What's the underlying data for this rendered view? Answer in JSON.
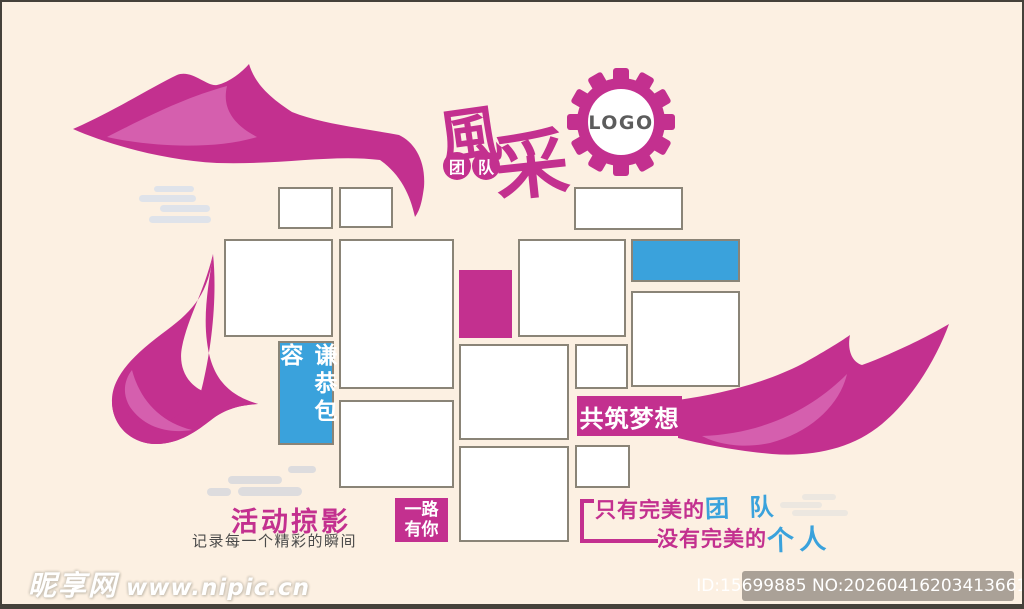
{
  "colors": {
    "background": "#fcf0e2",
    "magenta": "#c3308f",
    "magenta_light": "#d55fae",
    "blue": "#3aa2dc",
    "frame_border": "#8a8477",
    "subtitle_gray": "#4b4b4b",
    "logo_gray": "#5c5c5c"
  },
  "header": {
    "title_char1": "風",
    "title_char2": "采",
    "badge1": "团",
    "badge2": "队",
    "logo_label": "LOGO"
  },
  "wall": {
    "humble_box": "谦恭包容",
    "dream_box": "共筑梦想",
    "journey_line1": "一路",
    "journey_line2": "有你"
  },
  "footer_texts": {
    "activity_title": "活动掠影",
    "activity_subtitle": "记录每一个精彩的瞬间",
    "slogan_line1_magenta": "只有完美的",
    "slogan_line1_blue": "团 队",
    "slogan_line2_magenta": "没有完美的",
    "slogan_line2_blue": "个人"
  },
  "watermark": {
    "site_name": "昵享网",
    "site_url": "www.nipic.cn",
    "image_id": "ID:15699885 NO:20260416203413661104"
  }
}
